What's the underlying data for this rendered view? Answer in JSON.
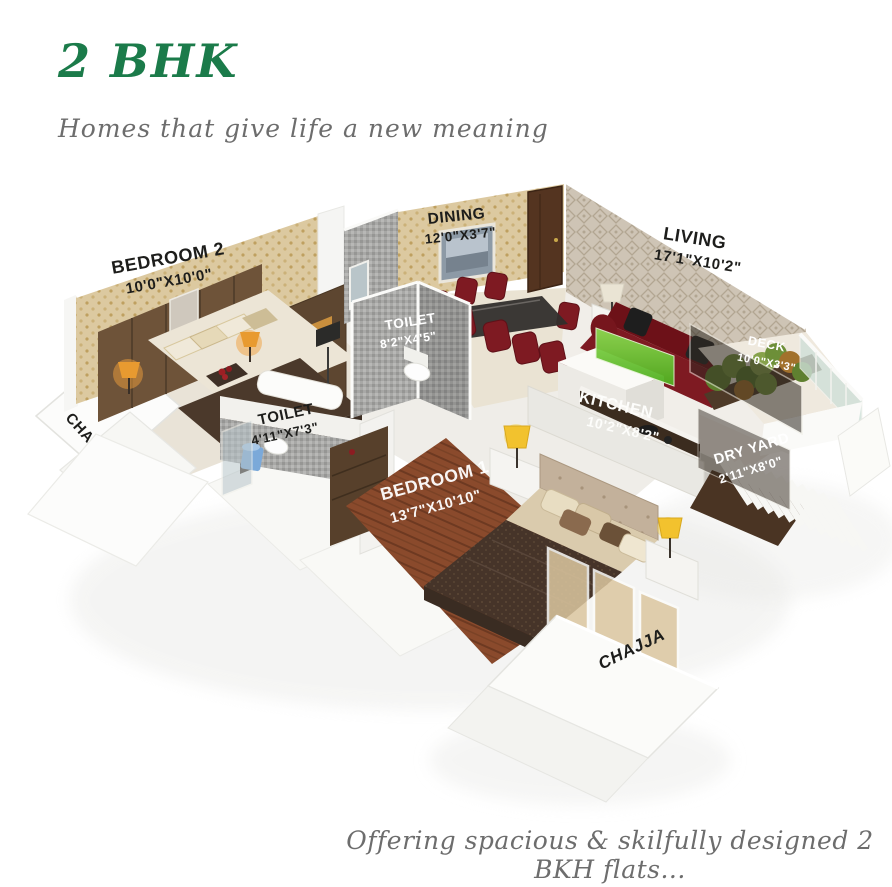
{
  "header": {
    "title": "2 BHK",
    "subtitle": "Homes that give life a new meaning"
  },
  "footer": {
    "caption": "Offering spacious & skilfully designed 2 BKH flats..."
  },
  "floorplan": {
    "rooms": {
      "bedroom2": {
        "label": "BEDROOM 2",
        "dims": "10'0\"X10'0\""
      },
      "dining": {
        "label": "DINING",
        "dims": "12'0\"X3'7\""
      },
      "living": {
        "label": "LIVING",
        "dims": "17'1\"X10'2\""
      },
      "toilet_common": {
        "label": "TOILET",
        "dims": "8'2\"X4'5\""
      },
      "toilet_attached": {
        "label": "TOILET",
        "dims": "4'11\"X7'3\""
      },
      "kitchen": {
        "label": "KITCHEN",
        "dims": "10'2\"X8'2\""
      },
      "deck": {
        "label": "DECK",
        "dims": "10'0\"X3'3\""
      },
      "dry_yard": {
        "label": "DRY YARD",
        "dims": "2'11\"X8'0\""
      },
      "bedroom1": {
        "label": "BEDROOM 1",
        "dims": "13'7\"X10'10\""
      },
      "chajja_left": {
        "label": "CHAJJA"
      },
      "chajja_front": {
        "label": "CHAJJA"
      }
    },
    "colors": {
      "title_green": "#1b7b4a",
      "script_gray": "#6d6d6d",
      "label_black": "#1d1d1b",
      "label_white": "#ffffff",
      "sofa_maroon": "#7e1a22",
      "kitchen_glass_green": "#6cc43a"
    }
  }
}
